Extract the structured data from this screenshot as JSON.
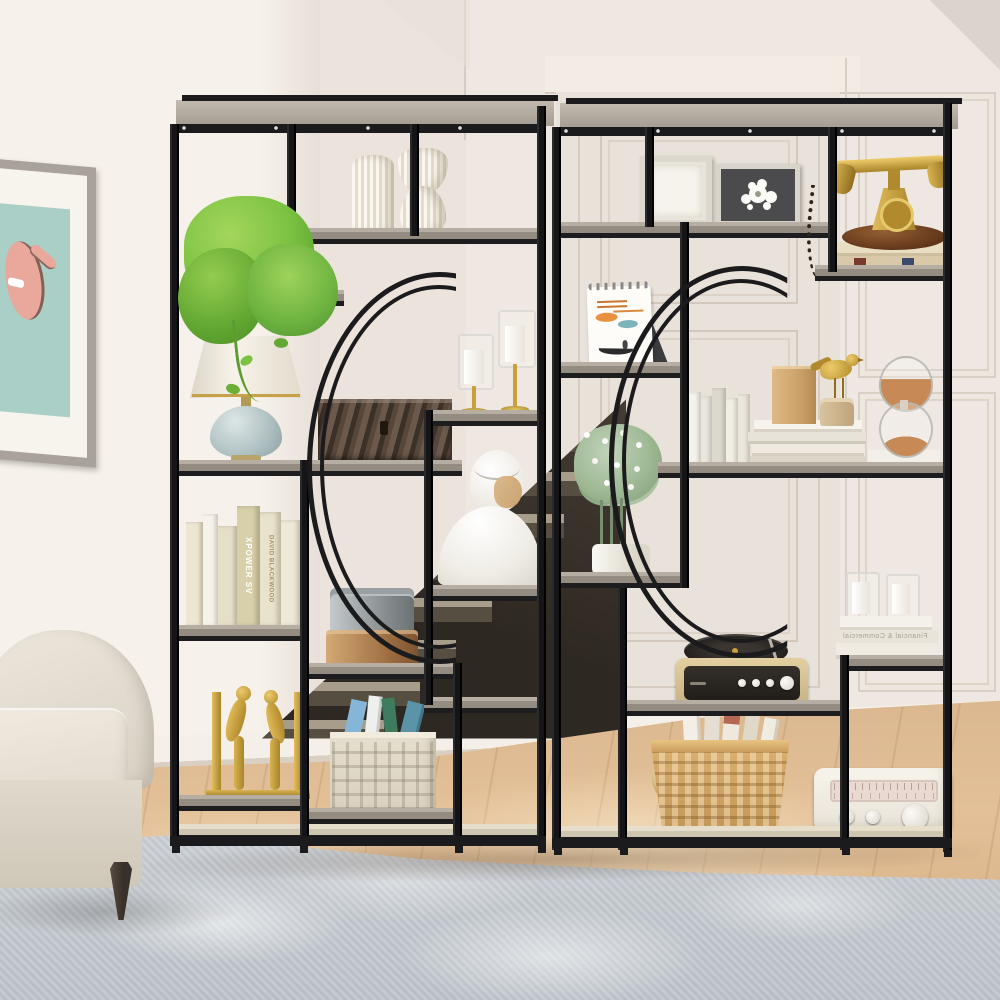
{
  "scene": {
    "setting": "Bright living room where two black metal moon-gate etagere bookcases act as a room divider in front of a dark staircase",
    "furniture": [
      "beige roll-arm sofa",
      "two black-frame bookcases with gray wood shelves and half-circle arc motifs",
      "gray mottled area rug",
      "light oak wood floor"
    ],
    "wall_art": "pink cartoon monkey print on teal mat in weathered gray frame",
    "background": [
      "cream walls",
      "paneled door behind right bookcase",
      "wainscot wall panels on right",
      "white baseboard"
    ]
  },
  "texts": {
    "book_spine_title": "XPOWER SV",
    "book_spine_author": "DAVID BLACKWOOD",
    "book_edge_title": "Financial & Commercial"
  },
  "palette": {
    "metal_frame": "#1b1b1d",
    "shelf_wood": "#948c81",
    "bottom_shelf_wood": "#d8cfbf",
    "wall": "#efe8e2",
    "door": "#e9e2da",
    "floor": "#dcb88f",
    "rug": "#c6cbd1",
    "sofa": "#e6e0d5",
    "accent_gold": "#c9a23a",
    "plant_green": "#7cc242",
    "sand_orange": "#c78a57"
  },
  "decor_items": {
    "left_unit": [
      "pothos-plant",
      "two-white-striped-vases",
      "gold-candle-holders",
      "ceramic-table-lamp",
      "rustic-wood-box",
      "white-bust-sculpture",
      "cream-books",
      "tin-canisters",
      "gold-figurine-bookends",
      "white-lattice-crate-with-books"
    ],
    "right_unit": [
      "two-picture-frames",
      "antique-gold-telephone",
      "desk-calendar",
      "white-books",
      "book-stack-wood-blocks-gold-bird",
      "hourglass",
      "eucalyptus-plant",
      "record-player",
      "candles-on-books",
      "wicker-basket-with-books",
      "white-vintage-radio"
    ]
  }
}
